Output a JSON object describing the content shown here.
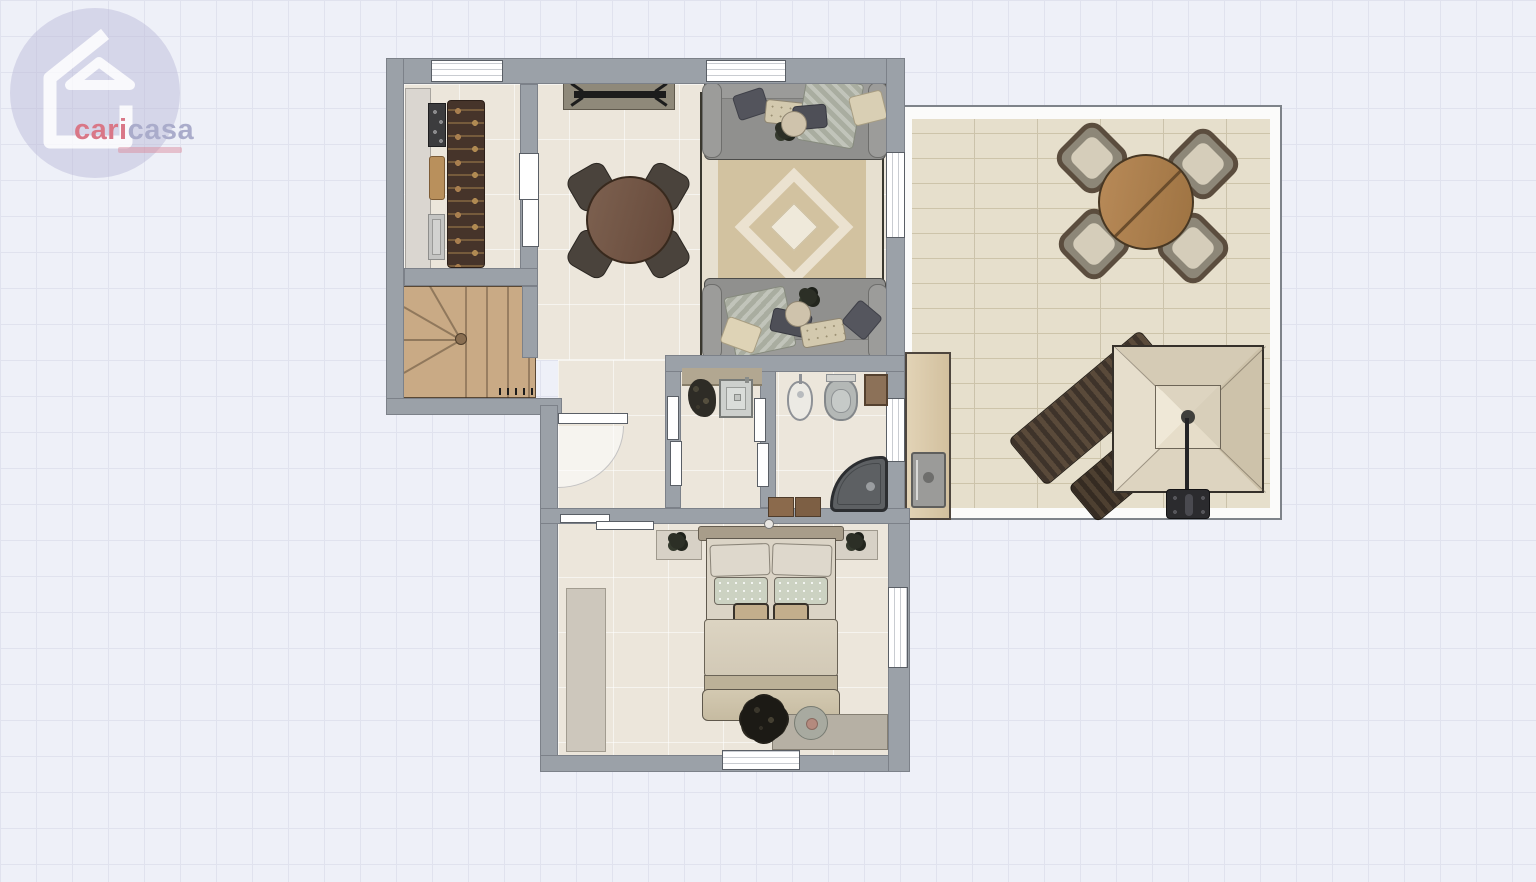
{
  "canvas": {
    "width_px": 1536,
    "height_px": 882,
    "grid_size_px": 36,
    "background_color": "#eef0f8",
    "grid_line_color": "#e0e2ee"
  },
  "logo": {
    "icon": "house-icon",
    "brand_part1": "cari",
    "brand_part2": "casa",
    "part1_color": "#d4596b",
    "part2_color": "#9a9cc0",
    "circle_color": "#b7b5d6",
    "tagline_legible": false
  },
  "floor_plan": {
    "wall_color": "#9ba1a8",
    "floor_color": "#ece6db",
    "terrace_paver_color": "#e6dfcc",
    "stairs_wood_color": "#c9aa85",
    "rooms": [
      {
        "name": "kitchen",
        "furniture": [
          "kitchen-counter",
          "cooktop",
          "cutting-board",
          "kitchen-sink",
          "utensil-runner-rug"
        ]
      },
      {
        "name": "staircase",
        "furniture": [
          "winder-stairs"
        ]
      },
      {
        "name": "dining-room",
        "furniture": [
          "console-bench",
          "round-dining-table",
          "dining-chair",
          "dining-chair",
          "dining-chair",
          "dining-chair"
        ]
      },
      {
        "name": "living-room",
        "furniture": [
          "sofa",
          "sofa",
          "area-rug",
          "throw-pillows",
          "side-table"
        ]
      },
      {
        "name": "hallway",
        "furniture": [
          "entry-door"
        ]
      },
      {
        "name": "laundry-room",
        "furniture": [
          "laundry-counter",
          "steel-sink",
          "basket"
        ]
      },
      {
        "name": "bathroom",
        "furniture": [
          "bidet",
          "toilet",
          "bath-cabinet",
          "corner-shower",
          "bath-mat"
        ]
      },
      {
        "name": "bedroom",
        "furniture": [
          "double-bed",
          "headboard",
          "nightstand",
          "nightstand",
          "wardrobe",
          "dresser",
          "plant",
          "round-tray"
        ]
      },
      {
        "name": "terrace",
        "furniture": [
          "outdoor-dining-table",
          "outdoor-chair",
          "outdoor-chair",
          "outdoor-chair",
          "outdoor-chair",
          "patio-umbrella",
          "chaise-lounge",
          "chaise-lounge",
          "outdoor-counter",
          "outdoor-sink"
        ]
      }
    ]
  }
}
